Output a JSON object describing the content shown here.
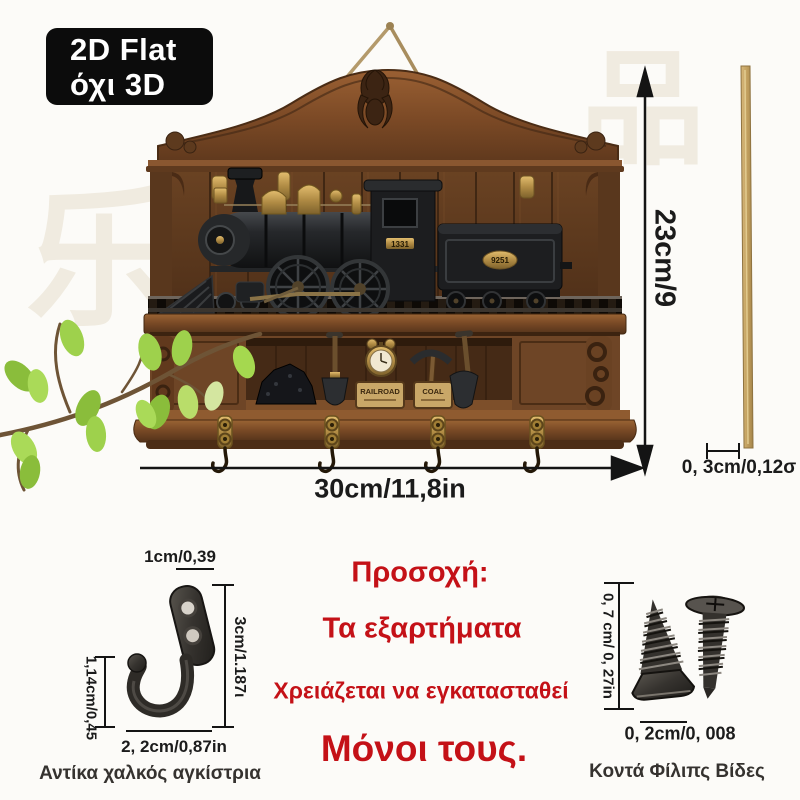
{
  "badge": {
    "line1": "2D Flat",
    "line2": "όχι 3D"
  },
  "watermark": {
    "char1": "乐",
    "char2": "品"
  },
  "product": {
    "cab_plate": "1331",
    "tender_plate": "9251",
    "sign_railroad": "RAILROAD",
    "sign_coal": "COAL"
  },
  "dimensions": {
    "height": "23cm/9",
    "width": "30cm/11,8in",
    "stick": "0, 3cm/0,12σ"
  },
  "hook_detail": {
    "top": "1cm/0,39",
    "right": "3cm/1.187ι",
    "left": "1,14cm/0,45",
    "bottom": "2, 2cm/0,87in",
    "caption": "Αντίκα χαλκός αγκίστρια"
  },
  "warning": {
    "line1": "Προσοχή:",
    "line2": "Τα εξαρτήματα",
    "line3": "Χρειάζεται να εγκατασταθεί",
    "line4": "Μόνοι τους."
  },
  "screws_detail": {
    "side": "0, 7 cm/ 0, 27in",
    "bottom": "0, 2cm/0, 008",
    "caption": "Κοντά Φίλιπς Βίδες"
  },
  "colors": {
    "warning_red": "#c41117",
    "badge_bg": "#0c0c0c",
    "wood_brown": "#7a4b27",
    "brass": "#b4904a",
    "leaf_green": "#9ed14c"
  }
}
